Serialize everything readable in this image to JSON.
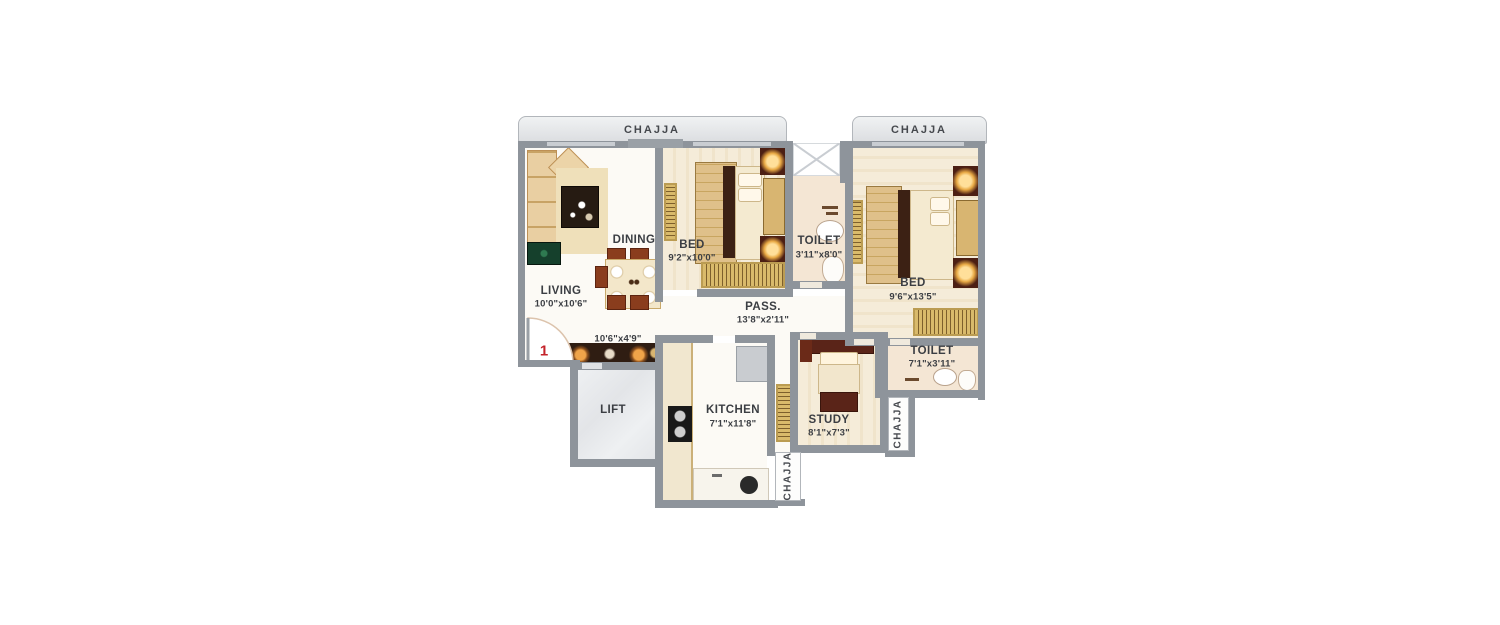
{
  "labels": {
    "chajja_top_left": "CHAJJA",
    "chajja_top_right": "CHAJJA",
    "chajja_right": "CHAJJA",
    "chajja_bottom": "CHAJJA"
  },
  "rooms": {
    "living": {
      "name": "LIVING",
      "dims": "10'0\"x10'6\""
    },
    "dining": {
      "name": "DINING"
    },
    "bed1": {
      "name": "BED",
      "dims": "9'2\"x10'0\""
    },
    "toilet1": {
      "name": "TOILET",
      "dims": "3'11\"x8'0\""
    },
    "bed2": {
      "name": "BED",
      "dims": "9'6\"x13'5\""
    },
    "pass": {
      "name": "PASS.",
      "dims": "13'8\"x2'11\""
    },
    "foyer": {
      "dims": "10'6\"x4'9\""
    },
    "toilet2": {
      "name": "TOILET",
      "dims": "7'1\"x3'11\""
    },
    "lift": {
      "name": "LIFT"
    },
    "kitchen": {
      "name": "KITCHEN",
      "dims": "7'1\"x11'8\""
    },
    "study": {
      "name": "STUDY",
      "dims": "8'1\"x7'3\""
    }
  },
  "entrance": {
    "marker": "1"
  },
  "colors": {
    "wall": "#8e949b",
    "chajja_fill": "#e5e7ea",
    "floor_wood": "#f4ebd7",
    "floor_toilet": "#f4e6d4",
    "accent_red": "#c4232a",
    "furniture_gold": "#d9ba6b",
    "furniture_maroon": "#4c1f13",
    "tv_green": "#15402c"
  }
}
